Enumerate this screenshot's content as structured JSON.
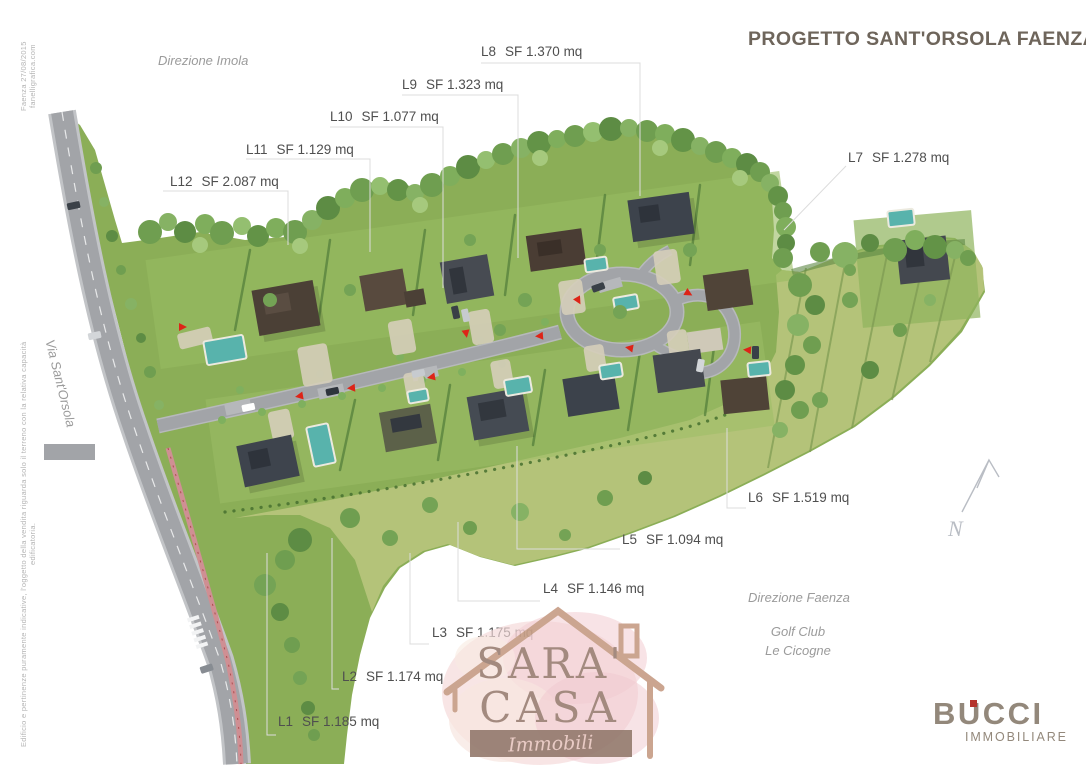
{
  "title": "PROGETTO SANT'ORSOLA FAENZA",
  "directions": {
    "imola": "Direzione Imola",
    "faenza": "Direzione Faenza"
  },
  "landmarks": {
    "street": "Via Sant'Orsola",
    "golf_club": [
      "Golf Club",
      "Le Cicogne"
    ],
    "north": "N"
  },
  "lots": [
    {
      "code": "L1",
      "area": "SF 1.185 mq"
    },
    {
      "code": "L2",
      "area": "SF 1.174 mq"
    },
    {
      "code": "L3",
      "area": "SF 1.175 mq"
    },
    {
      "code": "L4",
      "area": "SF 1.146 mq"
    },
    {
      "code": "L5",
      "area": "SF 1.094 mq"
    },
    {
      "code": "L6",
      "area": "SF 1.519 mq"
    },
    {
      "code": "L7",
      "area": "SF 1.278 mq"
    },
    {
      "code": "L8",
      "area": "SF 1.370 mq"
    },
    {
      "code": "L9",
      "area": "SF 1.323 mq"
    },
    {
      "code": "L10",
      "area": "SF 1.077 mq"
    },
    {
      "code": "L11",
      "area": "SF 1.129 mq"
    },
    {
      "code": "L12",
      "area": "SF 2.087 mq"
    }
  ],
  "credits": {
    "plan_info": "Faenza 27/08/2015    fanelligrafica.com",
    "disclaimer": "Edificio e pertinenze puramente indicative, l'oggetto della vendita riguarda solo il terreno con la relativa capacità edificatoria."
  },
  "watermark": {
    "line1": "SARA'",
    "line2": "CASA",
    "tagline": "Immobili"
  },
  "agency": {
    "name": "BUCCI",
    "subtitle": "IMMOBILIARE"
  },
  "colors": {
    "title": "#6e655b",
    "label": "#4f4f4f",
    "muted": "#9b9b9b",
    "leader": "#dcdcdc",
    "accent_red": "#dd2418",
    "grass": "#8bae57",
    "meadow": "#b8c57d",
    "road": "#a2a4a8",
    "pool": "#58b3ac",
    "bike_path": "#cf8f93",
    "logo_red": "#b5342c"
  }
}
